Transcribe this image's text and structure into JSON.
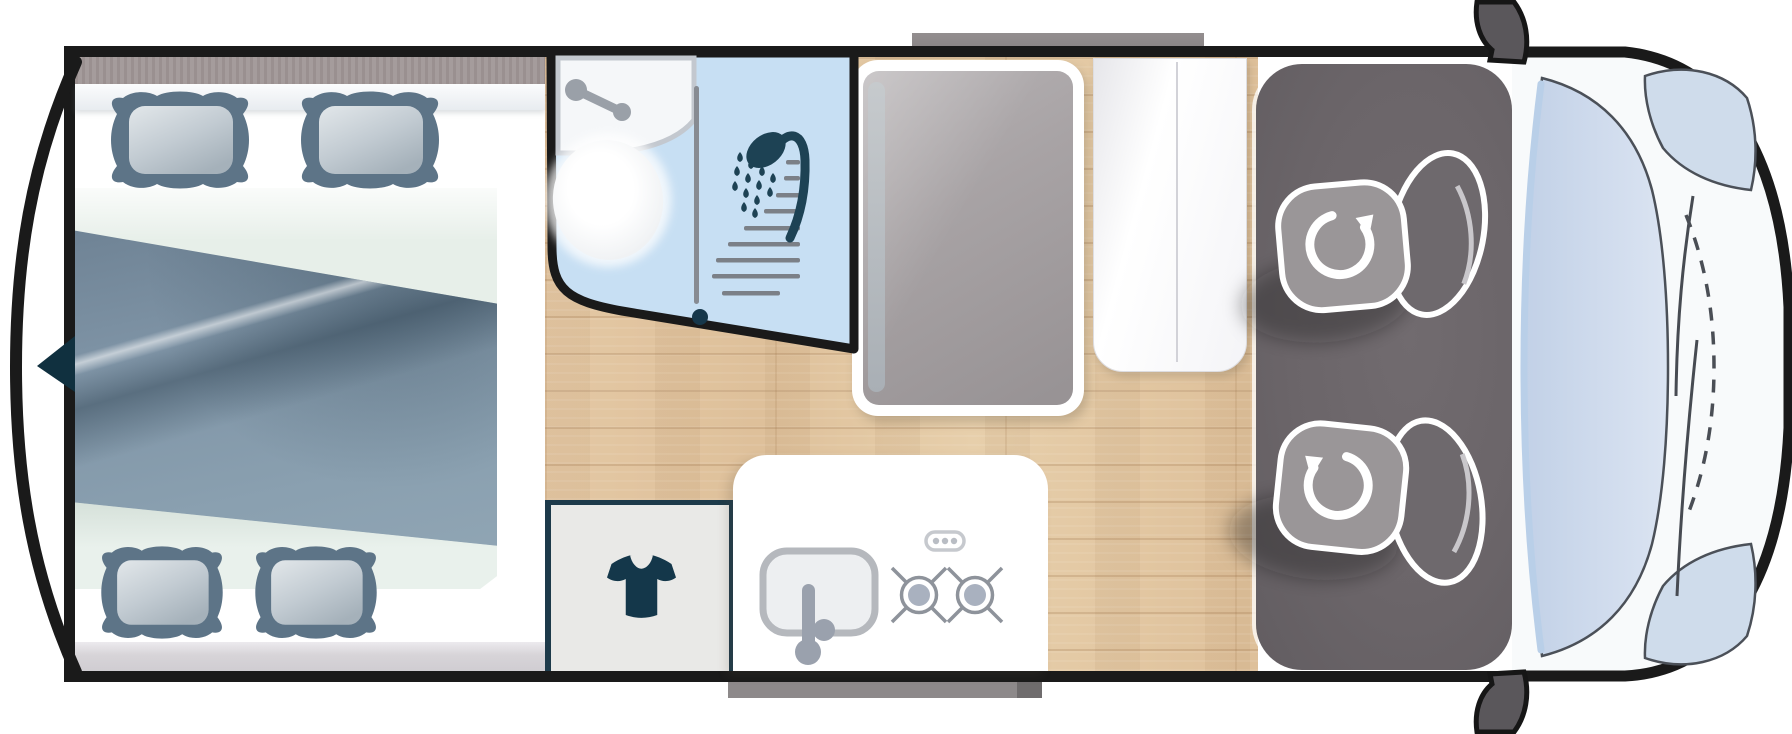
{
  "meta": {
    "title": "campervan-floorplan-top-view",
    "type": "diagram"
  },
  "colors": {
    "outline": "#1a1a1a",
    "wood_floor": "#e2c6a2",
    "bathroom_floor": "#c7dff3",
    "accent_navy": "#1d4254",
    "blanket_slate": "#8095a7",
    "pillow_dark": "#5d7487",
    "cab_floor": "#6b6568",
    "seat_grey": "#9a9698",
    "hood_white": "#f8fafb",
    "windshield_blue": "#ccd9ea",
    "fridge_grey": "#a8a3a5",
    "step_grey": "#8d898a"
  },
  "areas": {
    "bed": "rear-double-bed",
    "bathroom": "bathroom",
    "shower": "shower",
    "toilet": "toilet",
    "washbasin": "washbasin",
    "fridge": "fridge-cabinet",
    "cabinet": "tall-cabinet",
    "wardrobe": "wardrobe",
    "kitchen": "kitchenette",
    "sink": "kitchen-sink",
    "hob": "two-burner-hob",
    "cab": "driver-cab",
    "seats": "two-swivel-seats",
    "front": "vehicle-front",
    "windshield": "windshield",
    "mirrors": "side-mirrors",
    "step": "entry-step",
    "awning": "awning-rail",
    "rear": "rear-contour"
  },
  "icons": {
    "shower_head": "shower-head-icon",
    "water_drops": "water-drops-icon",
    "tshirt": "tshirt-wardrobe-icon",
    "rotate_seat": "rotation-arrow-icon",
    "faucet": "faucet-icon",
    "burner": "gas-burner-icon",
    "door_pivot": "door-pivot-dot"
  }
}
